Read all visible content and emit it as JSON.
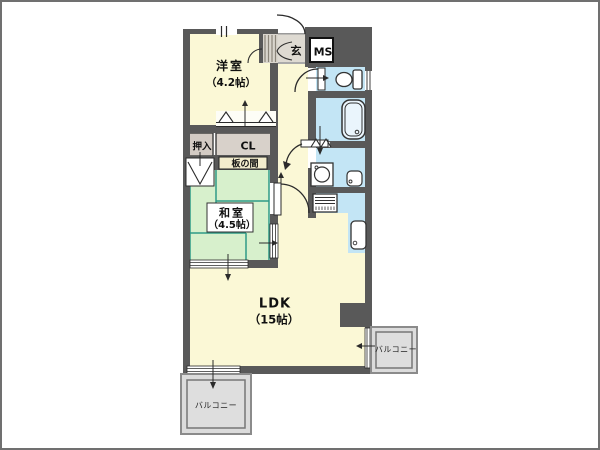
{
  "floorplan": {
    "rooms": {
      "western": {
        "name": "洋室",
        "size": "（4.2帖）"
      },
      "japanese": {
        "name": "和室",
        "size": "（4.5帖）"
      },
      "ldk": {
        "name": "LDK",
        "size": "（15帖）"
      },
      "entrance": {
        "label": "玄"
      },
      "meter_box": {
        "label": "MS"
      },
      "oshiire": {
        "label": "押入"
      },
      "closet": {
        "label": "CL"
      },
      "itanoma": {
        "label": "板の間"
      },
      "balconies": [
        {
          "label": "バルコニー"
        },
        {
          "label": "バルコニー"
        }
      ]
    },
    "colors": {
      "wall": "#595959",
      "room_cream": "#fbf8d6",
      "tatami_green": "#d7f0cc",
      "tatami_line": "#2f9a86",
      "water_blue": "#c3e5f5",
      "closet_tan": "#d3cbc4",
      "genkan_gray": "#dedad2",
      "balcony_gray": "#dcdcdc",
      "label_cream": "#f3edcd"
    },
    "icons": [
      "entrance-door-arc",
      "toilet-icon",
      "bathtub-icon",
      "washing-machine-icon",
      "washbasin-icon",
      "stove-icon",
      "kitchen-sink-icon",
      "window-band",
      "folding-door",
      "sliding-door",
      "door-arc"
    ]
  }
}
